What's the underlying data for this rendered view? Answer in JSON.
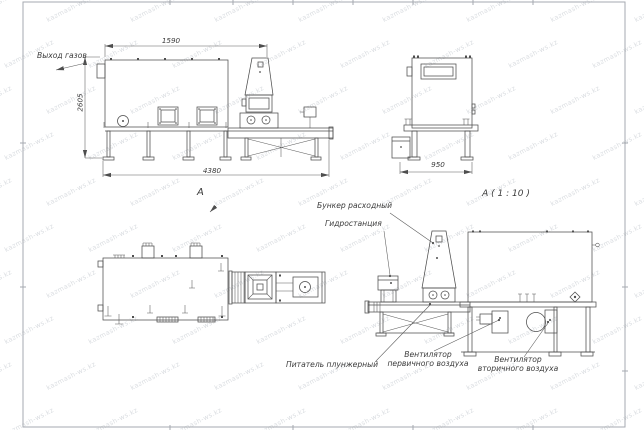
{
  "watermark": {
    "text": "kazmash-ws.kz"
  },
  "labels": {
    "gas_outlet": "Выход газов",
    "hopper": "Бункер расходный",
    "hydrostation": "Гидростанция",
    "feeder": "Питатель плунжерный",
    "fan_primary": "Вентилятор\nпервичного воздуха",
    "fan_secondary": "Вентилятор\nвторичного воздуха"
  },
  "dimensions": {
    "side_top_width": "1590",
    "side_height": "2605",
    "side_total_length": "4380",
    "end_width": "950"
  },
  "view_labels": {
    "plan_view_arrow": "А",
    "detail_title": "А ( 1 : 10 )"
  },
  "colors": {
    "line": "#4e4e4e",
    "frame": "#a6aab0",
    "watermark": "#949aa6"
  }
}
